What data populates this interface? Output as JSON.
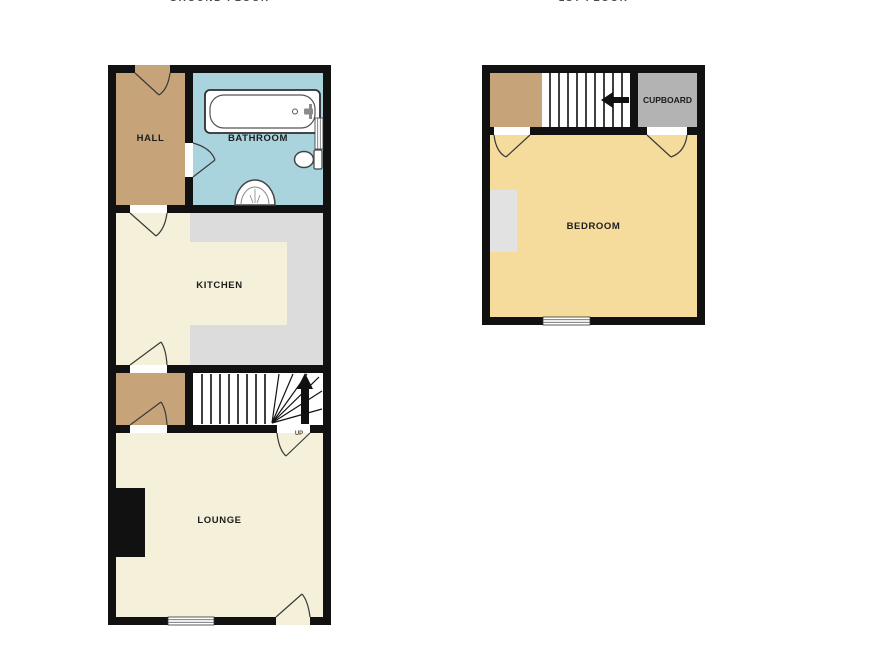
{
  "captions": {
    "ground": "GROUND FLOOR",
    "first": "1ST FLOOR"
  },
  "ground_floor": {
    "hall_label": "HALL",
    "bathroom_label": "BATHROOM",
    "kitchen_label": "KITCHEN",
    "lounge_label": "LOUNGE",
    "up_label": "UP"
  },
  "first_floor": {
    "bedroom_label": "BEDROOM",
    "cupboard_label": "CUPBOARD"
  },
  "fixtures": [
    "bathtub",
    "toilet",
    "sink",
    "staircase",
    "up-arrow",
    "fireplace",
    "window",
    "door-swing",
    "kitchen-counter"
  ],
  "colors": {
    "wall": "#111111",
    "hall_tan": "#c6a379",
    "bathroom_blue": "#a9d4de",
    "floor_cream": "#f5f0d9",
    "counter_gray": "#dcdcdc",
    "bedroom_yellow": "#f5dc9c",
    "cupboard_gray": "#b3b3b3",
    "alcove_gray": "#e2e2e2"
  }
}
